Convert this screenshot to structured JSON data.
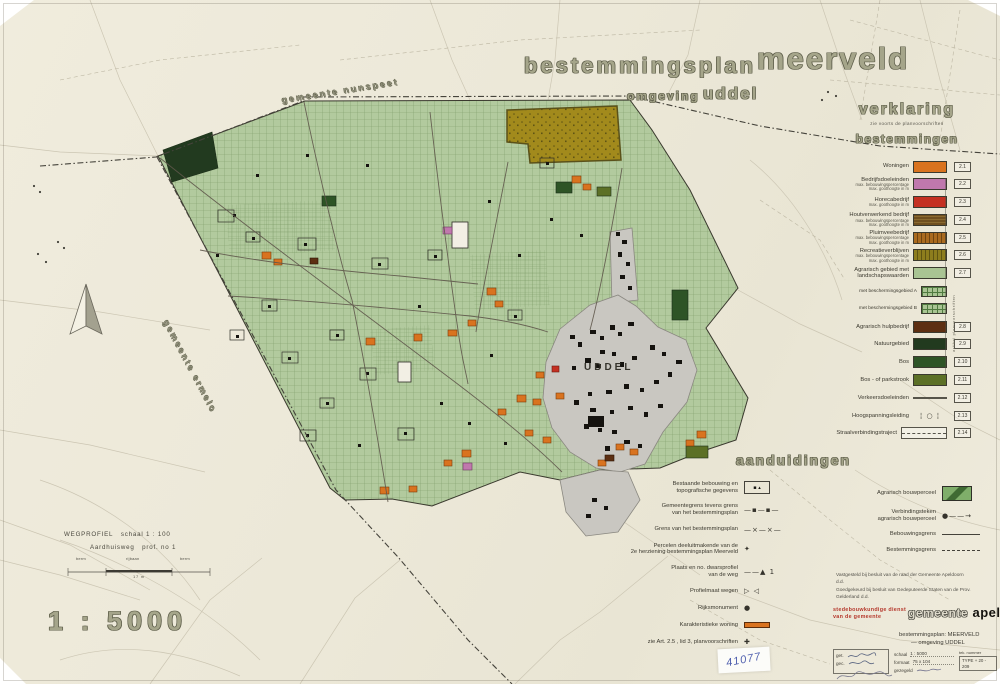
{
  "sheet": {
    "scale_text": "1 : 5000",
    "sticker_number": "41077",
    "paper_color": "#ede9da"
  },
  "title": {
    "main": "bestemmingsplan",
    "emphasis": "meerveld",
    "sub_prefix": "omgeving",
    "sub_emphasis": "uddel"
  },
  "map": {
    "labels": {
      "municipality_north": "gemeente nunspeet",
      "municipality_west": "gemeente ermelo",
      "village": "UDDEL"
    },
    "colors": {
      "plan_area_green": "#b2ca9e",
      "grid_line_green": "#7e9c69",
      "village_gray": "#c9c7c1",
      "forest_dark_green": "#2e5426",
      "nature_dark_green": "#223a1f",
      "recreation_mustard": "#a28a1c",
      "housing_orange": "#d9731f",
      "business_pink": "#c078ad",
      "horeca_red": "#c43022",
      "agrarian_help_brown": "#5d2f12"
    }
  },
  "legend": {
    "heading": "verklaring",
    "subheading": "zie voorts de planvoorschriften",
    "section": "bestemmingen",
    "side_note": "artikel planvoorschriften",
    "items": [
      {
        "label": "Woningen",
        "code": "2.1",
        "swatch": "orange"
      },
      {
        "label": "Bedrijfsdoeleinden",
        "sub1": "max. bebouwingspercentage",
        "sub2": "max. goothoogte in m",
        "code": "2.2",
        "swatch": "pink"
      },
      {
        "label": "Horecabedrijf",
        "sub1": "max. goothoogte in m",
        "code": "2.3",
        "swatch": "red"
      },
      {
        "label": "Houtverwerkend bedrijf",
        "sub1": "max. bebouwingspercentage",
        "sub2": "max. goothoogte in m",
        "code": "2.4",
        "swatch": "brownhatch"
      },
      {
        "label": "Pluimveebedrijf",
        "sub1": "max. bebouwingspercentage",
        "sub2": "max. goothoogte in m",
        "code": "2.5",
        "swatch": "rusthatch"
      },
      {
        "label": "Recreatieverblijven",
        "sub1": "max. bebouwingspercentage",
        "sub2": "max. goothoogte in m",
        "code": "2.6",
        "swatch": "olivehatch"
      },
      {
        "label": "Agrarisch gebied met",
        "label2": "landschapswaarden",
        "code": "2.7",
        "swatch": "lightgreen"
      },
      {
        "label": "met beschermingsgebied A",
        "kind": "sub",
        "swatch": "gridgreen"
      },
      {
        "label": "met beschermingsgebied B",
        "kind": "sub",
        "swatch": "gridgreen"
      },
      {
        "label": "Agrarisch hulpbedrijf",
        "code": "2.8",
        "swatch": "darkbrown"
      },
      {
        "label": "Natuurgebied",
        "code": "2.9",
        "swatch": "verydarkgreen"
      },
      {
        "label": "Bos",
        "code": "2.10",
        "swatch": "bosgreen"
      },
      {
        "label": "Bos - of parkstrook",
        "code": "2.11",
        "swatch": "parkgreen"
      },
      {
        "label": "Verkeersdoeleinden",
        "code": "2.12",
        "swatch": "line"
      },
      {
        "label": "Hoogspanningsleiding",
        "code": "2.13",
        "swatch": "hv",
        "glyph": "¦ ○ ¦"
      },
      {
        "label": "Straalverbindingstraject",
        "code": "2.14",
        "swatch": "corridor"
      }
    ]
  },
  "aanduidingen": {
    "heading": "aanduidingen",
    "left_items": [
      {
        "label": "Bestaande bebouwing en",
        "label2": "topografische gegevens",
        "symtype": "box-topo",
        "glyph": "▪ ▴",
        "symname": "existing-buildings-symbol"
      },
      {
        "label": "Gemeentegrens tevens grens",
        "label2": "van het bestemmingsplan",
        "symtype": "glyph",
        "glyph": "—▪—▪—",
        "symname": "municipal-boundary-symbol"
      },
      {
        "label": "Grens van het bestemmingsplan",
        "symtype": "glyph",
        "glyph": "—×—×—",
        "symname": "plan-boundary-symbol"
      },
      {
        "label": "Percelen deeluitmakende van de",
        "label2": "2e herziening bestemmingsplan Meerveld",
        "symtype": "glyph",
        "glyph": "✦",
        "symname": "revision-parcel-symbol"
      },
      {
        "label": "Plaats en no. dwarsprofiel",
        "label2": "van de weg",
        "symtype": "glyph",
        "glyph": "——▲ 1",
        "symname": "road-profile-location-symbol"
      },
      {
        "label": "Profielmaat wegen",
        "symtype": "glyph",
        "glyph": "▷ ◁",
        "symname": "road-profile-measure-symbol"
      },
      {
        "label": "Rijksmonument",
        "symtype": "glyph",
        "glyph": "●",
        "symname": "national-monument-symbol"
      },
      {
        "label": "Karakteristieke woning",
        "symtype": "bar-orange",
        "symname": "characteristic-dwelling-symbol"
      },
      {
        "label": "zie Art. 2.5 , lid 3, planvoorschriften",
        "symtype": "glyph",
        "glyph": "✚",
        "symname": "article-reference-symbol"
      }
    ],
    "right_items": [
      {
        "label": "Agrarisch bouwperceel",
        "symtype": "swatch-green",
        "symname": "agrarian-building-plot-swatch"
      },
      {
        "label": "Verbindingsteken",
        "label2": "agrarisch bouwperceel",
        "symtype": "glyph",
        "glyph": "●——→",
        "symname": "connection-mark-symbol"
      },
      {
        "label": "Bebouwingsgrens",
        "symtype": "line-solid",
        "symname": "building-limit-line"
      },
      {
        "label": "Bestemmingsgrens",
        "symtype": "line-dashed",
        "symname": "zoning-boundary-line"
      }
    ]
  },
  "wegprofiel": {
    "title": "WEGPROFIEL",
    "scale": "schaal 1 : 100",
    "road": "Aardhuisweg",
    "profile_no": "prof. no 1",
    "segments": [
      "berm",
      "rijbaan",
      "berm"
    ],
    "dimension": "17 m"
  },
  "titleblock": {
    "approval1": "Vastgesteld bij besluit van de raad der Gemeente Apeldoorn",
    "approval1_dd": "d.d.",
    "approval2": "Goedgekeurd bij besluit van Gedeputeerde Staten van de Prov. Gelderland",
    "approval2_dd": "d.d.",
    "dept_line1": "stedebouwkundige dienst",
    "dept_line2": "van de gemeente",
    "logo_word1": "gemeente",
    "logo_word2": "apeldoorn",
    "plan_line1": "bestemmingsplan:  MEERVELD",
    "plan_line2": "— omgeving  UDDEL",
    "form": {
      "get_label": "get.",
      "gec_label": "gec.",
      "schaal_label": "schaal",
      "schaal_value": "1 : 5000",
      "formaat_label": "formaat",
      "formaat_value": "75 x 104",
      "gezegeld_label": "gezegeld",
      "tek_label": "tek. nummer",
      "type_label": "TYPE",
      "tek_value": "+ 20 - 209"
    }
  }
}
